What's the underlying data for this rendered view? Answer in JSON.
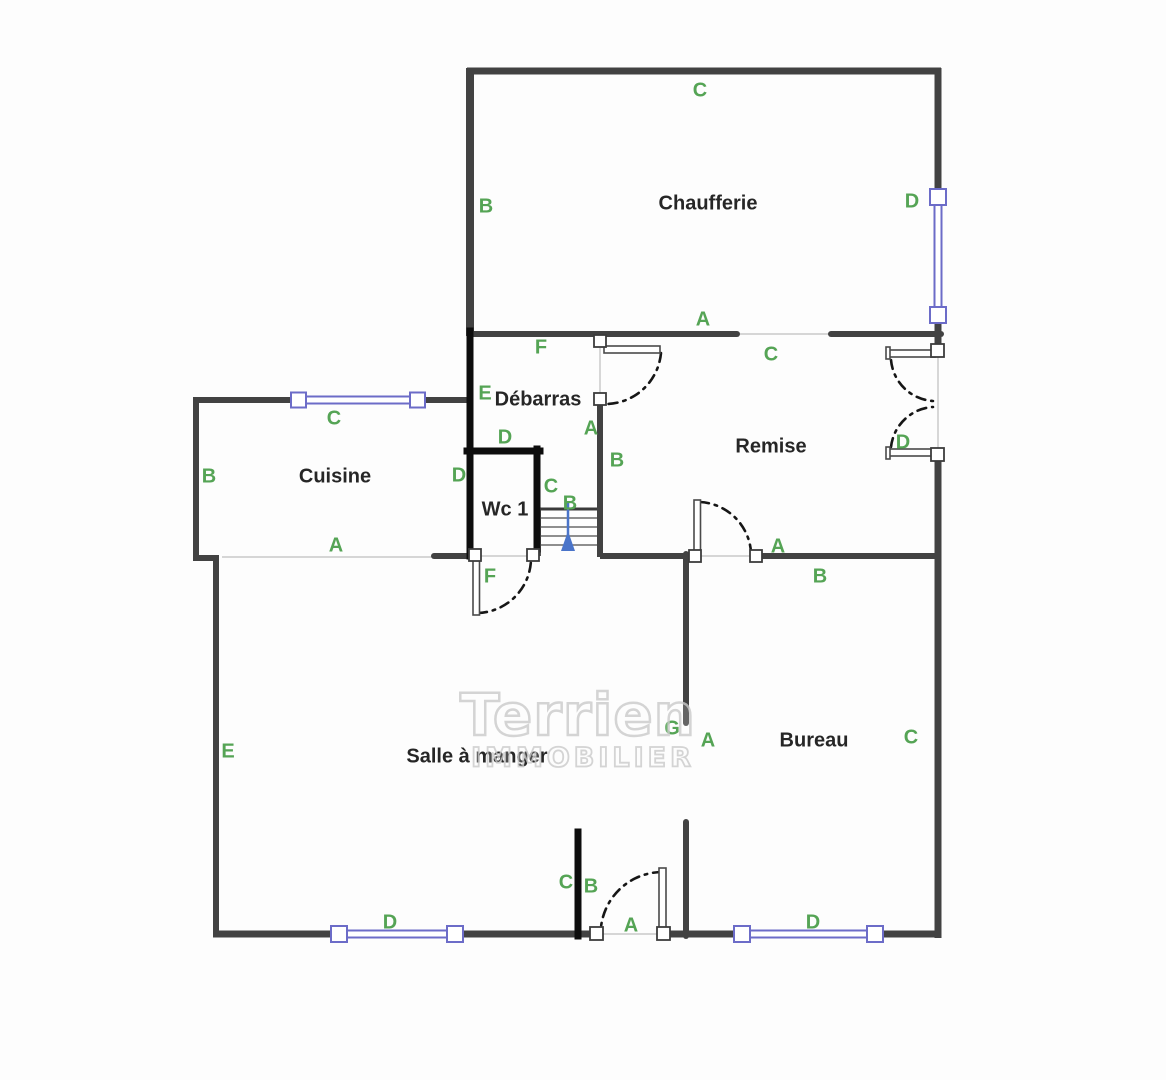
{
  "watermark": {
    "line1": "Terrien",
    "line2": "IMMOBILIER"
  },
  "colors": {
    "wall": "#424242",
    "black_wall": "#0d0d0d",
    "window": "#6c6cc8",
    "label_green": "#55a455",
    "room_text": "#262626",
    "arrow_blue": "#4a74c9",
    "open_line": "#cacaca",
    "background": "#fdfdfd",
    "watermark": "#c9c9c9"
  },
  "rooms": [
    {
      "name": "Chaufferie",
      "x": 708,
      "y": 204
    },
    {
      "name": "Débarras",
      "x": 538,
      "y": 400
    },
    {
      "name": "Remise",
      "x": 771,
      "y": 447
    },
    {
      "name": "Cuisine",
      "x": 335,
      "y": 477
    },
    {
      "name": "Wc 1",
      "x": 505,
      "y": 510
    },
    {
      "name": "Salle à manger",
      "x": 477,
      "y": 757
    },
    {
      "name": "Bureau",
      "x": 814,
      "y": 741
    }
  ],
  "wall_labels": [
    {
      "text": "C",
      "x": 700,
      "y": 91
    },
    {
      "text": "B",
      "x": 486,
      "y": 207
    },
    {
      "text": "D",
      "x": 912,
      "y": 202
    },
    {
      "text": "A",
      "x": 703,
      "y": 320
    },
    {
      "text": "F",
      "x": 541,
      "y": 348
    },
    {
      "text": "C",
      "x": 771,
      "y": 355
    },
    {
      "text": "E",
      "x": 485,
      "y": 394
    },
    {
      "text": "C",
      "x": 334,
      "y": 419
    },
    {
      "text": "A",
      "x": 591,
      "y": 429
    },
    {
      "text": "D",
      "x": 505,
      "y": 438
    },
    {
      "text": "D",
      "x": 903,
      "y": 443
    },
    {
      "text": "B",
      "x": 617,
      "y": 461
    },
    {
      "text": "D",
      "x": 459,
      "y": 476
    },
    {
      "text": "B",
      "x": 209,
      "y": 477
    },
    {
      "text": "C",
      "x": 551,
      "y": 487
    },
    {
      "text": "B",
      "x": 570,
      "y": 504
    },
    {
      "text": "A",
      "x": 336,
      "y": 546
    },
    {
      "text": "A",
      "x": 778,
      "y": 547
    },
    {
      "text": "F",
      "x": 490,
      "y": 577
    },
    {
      "text": "B",
      "x": 820,
      "y": 577
    },
    {
      "text": "G",
      "x": 672,
      "y": 729
    },
    {
      "text": "A",
      "x": 708,
      "y": 741
    },
    {
      "text": "C",
      "x": 911,
      "y": 738
    },
    {
      "text": "E",
      "x": 228,
      "y": 752
    },
    {
      "text": "C",
      "x": 566,
      "y": 883
    },
    {
      "text": "B",
      "x": 591,
      "y": 887
    },
    {
      "text": "D",
      "x": 390,
      "y": 923
    },
    {
      "text": "D",
      "x": 813,
      "y": 923
    },
    {
      "text": "A",
      "x": 631,
      "y": 926
    }
  ]
}
